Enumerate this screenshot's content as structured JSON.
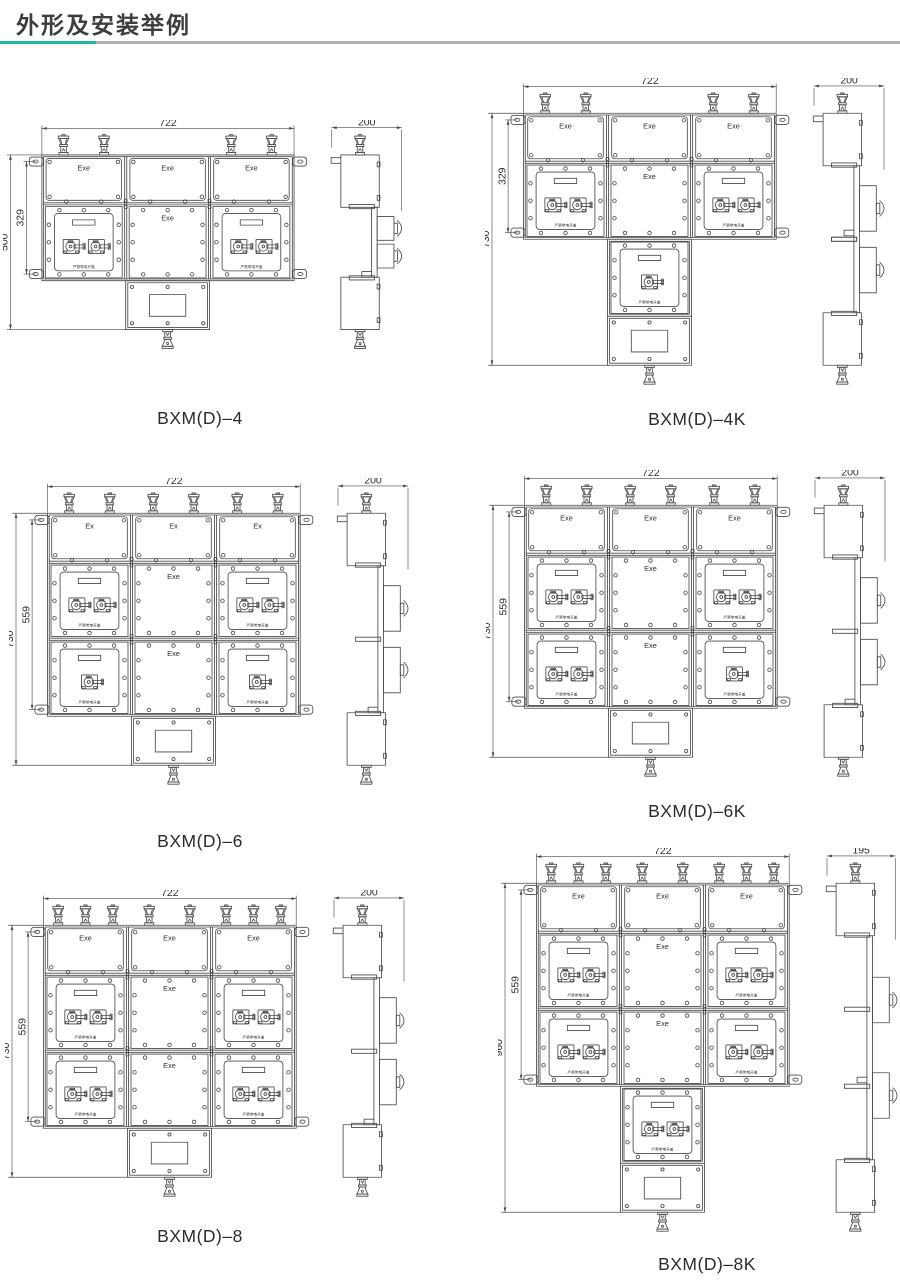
{
  "page": {
    "title": "外形及安装举例",
    "accent_color": "#21b3a4",
    "rule_color": "#b0b0b0",
    "line_color": "#4a4a4a",
    "text_color": "#2f2f2f"
  },
  "figures": [
    {
      "caption": "BXM(D)–4",
      "dim_width": "722",
      "dim_side": "200",
      "dim_inner": "329",
      "dim_outer": "500",
      "top_panel_label": "Exe",
      "center_panel_label": "Exe",
      "warning_label": "严禁带电开盖",
      "gland_groups": [
        2,
        0,
        2
      ],
      "rows": [
        {
          "left_switches": 2,
          "right_switches": 2
        }
      ],
      "tail_switch_panels": []
    },
    {
      "caption": "BXM(D)–4K",
      "dim_width": "722",
      "dim_side": "200",
      "dim_inner": "329",
      "dim_outer": "730",
      "top_panel_label": "Exe",
      "center_panel_label": "Exe",
      "warning_label": "严禁带电开盖",
      "gland_groups": [
        2,
        0,
        2
      ],
      "rows": [
        {
          "left_switches": 2,
          "right_switches": 2
        }
      ],
      "tail_switch_panels": [
        1
      ]
    },
    {
      "caption": "BXM(D)–6",
      "dim_width": "722",
      "dim_side": "200",
      "dim_inner": "559",
      "dim_outer": "730",
      "top_panel_label": "Ex",
      "center_panel_label": "Exe",
      "warning_label": "严禁带电开盖",
      "gland_groups": [
        2,
        2,
        2
      ],
      "rows": [
        {
          "left_switches": 2,
          "right_switches": 2
        },
        {
          "left_switches": 1,
          "right_switches": 1
        }
      ],
      "tail_switch_panels": []
    },
    {
      "caption": "BXM(D)–6K",
      "dim_width": "722",
      "dim_side": "200",
      "dim_inner": "559",
      "dim_outer": "730",
      "top_panel_label": "Exe",
      "center_panel_label": "Exe",
      "warning_label": "严禁带电开盖",
      "gland_groups": [
        2,
        2,
        2
      ],
      "rows": [
        {
          "left_switches": 2,
          "right_switches": 2
        },
        {
          "left_switches": 2,
          "right_switches": 1
        }
      ],
      "tail_switch_panels": []
    },
    {
      "caption": "BXM(D)–8",
      "dim_width": "722",
      "dim_side": "200",
      "dim_inner": "559",
      "dim_outer": "730",
      "top_panel_label": "Exe",
      "center_panel_label": "Exe",
      "warning_label": "严禁带电开盖",
      "gland_groups": [
        3,
        2,
        3
      ],
      "rows": [
        {
          "left_switches": 2,
          "right_switches": 2
        },
        {
          "left_switches": 2,
          "right_switches": 2
        }
      ],
      "tail_switch_panels": []
    },
    {
      "caption": "BXM(D)–8K",
      "dim_width": "722",
      "dim_side": "195",
      "dim_inner": "559",
      "dim_outer": "960",
      "top_panel_label": "Exe",
      "center_panel_label": "Exe",
      "warning_label": "严禁带电开盖",
      "gland_groups": [
        3,
        2,
        3
      ],
      "rows": [
        {
          "left_switches": 2,
          "right_switches": 2
        },
        {
          "left_switches": 2,
          "right_switches": 2
        }
      ],
      "tail_switch_panels": [
        2
      ]
    }
  ]
}
